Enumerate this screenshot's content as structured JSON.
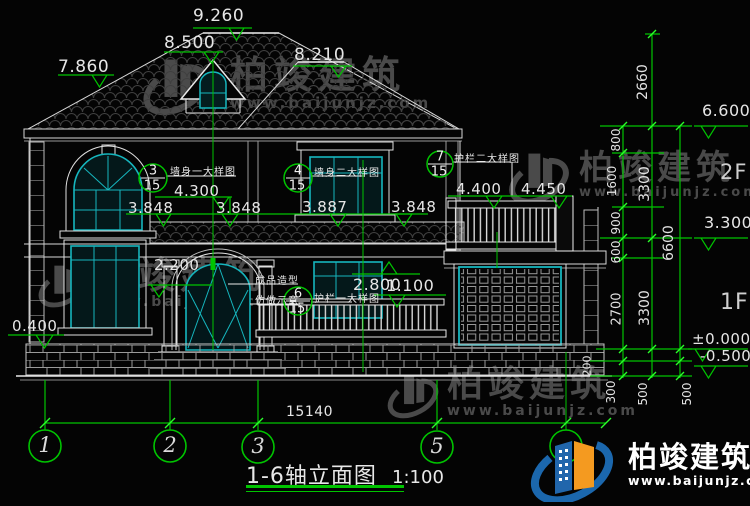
{
  "watermark": {
    "brand": "柏竣建筑",
    "url": "www.baijunjz.com"
  },
  "logo": {
    "brand": "柏竣建筑",
    "url": "www.baijunjz.com"
  },
  "title": {
    "name": "1-6轴立面图",
    "scale": "1:100"
  },
  "floors": {
    "second": "2F",
    "first": "1F"
  },
  "roof_marks": {
    "m9260": "9.260",
    "m8500": "8.500",
    "m8210": "8.210",
    "m7860": "7.860"
  },
  "level_marks": {
    "m6600": "6.600",
    "m3300": "3.300",
    "m0000": "±0.000",
    "mneg0500": "-0.500",
    "m0400": "0.400",
    "m2200": "2.200",
    "m2800": "2.800",
    "m1100": "1.100"
  },
  "window_marks": {
    "m4300": "4.300",
    "m3848a": "3.848",
    "m3848b": "3.848",
    "m3887": "3.887",
    "m3848c": "3.848",
    "m4400": "4.400",
    "m4450": "4.450"
  },
  "callouts": {
    "wall1": {
      "num": "3",
      "sheet": "15",
      "label": "墙身一大样图"
    },
    "wall2": {
      "num": "4",
      "sheet": "15",
      "label": "墙身二大样图"
    },
    "rail2": {
      "num": "7",
      "sheet": "15",
      "label": "护栏二大样图"
    },
    "rail1": {
      "num": "6",
      "sheet": "15",
      "label": "护栏一大样图"
    }
  },
  "notes": {
    "line1": "成品造型",
    "line2": "仿做示意"
  },
  "vdims": {
    "d2660": "2660",
    "d800": "800",
    "d1600": "1600",
    "d3300a": "3300",
    "d900": "900",
    "d600": "600",
    "d6600": "6600",
    "d2700": "2700",
    "d3300b": "3300",
    "d200": "200",
    "d300": "300",
    "d500a": "500",
    "d500b": "500"
  },
  "hdims": {
    "total": "15140"
  },
  "axes": {
    "a1": "1",
    "a2": "2",
    "a3": "3",
    "a5": "5"
  },
  "colors": {
    "dim_green": "#00c400",
    "frame_cyan": "#16b6be",
    "logo_blue": "#1b67ad",
    "logo_orange": "#f49a20"
  }
}
